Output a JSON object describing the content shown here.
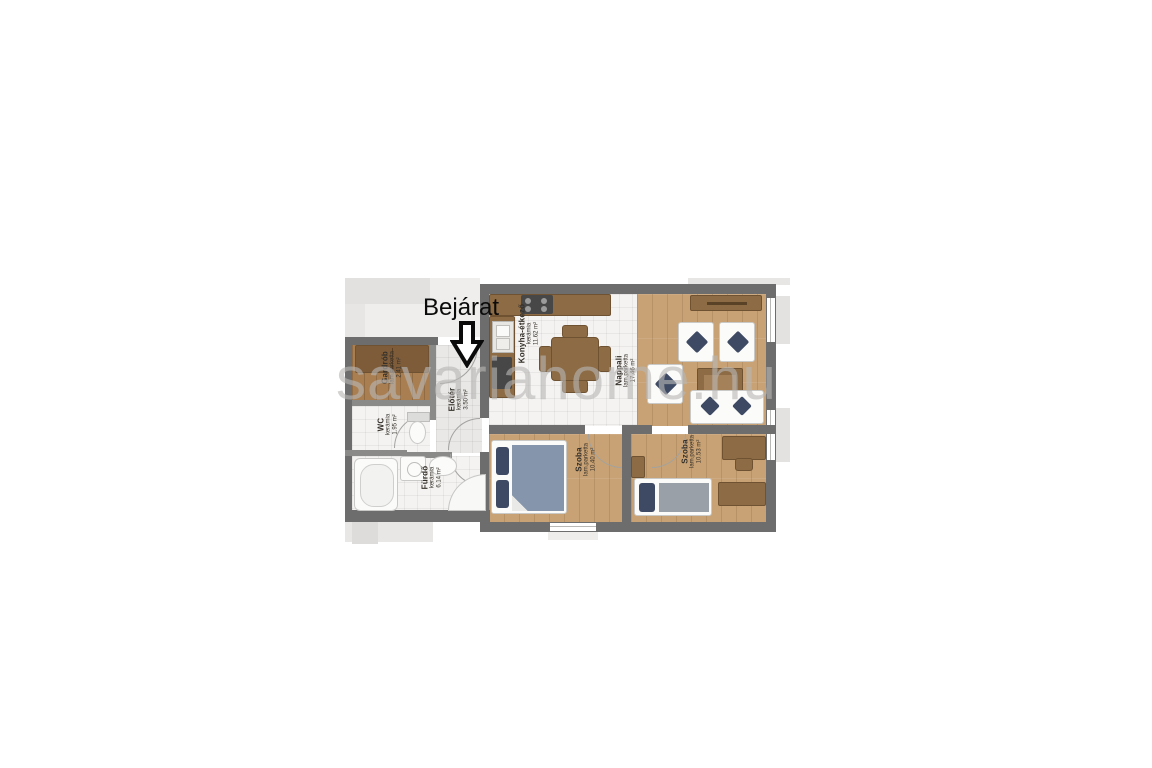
{
  "watermark": "savariahome.hu",
  "entrance": {
    "label": "Bejárat"
  },
  "rooms": {
    "gardrob": {
      "name": "Gardrób",
      "floor": "lam.parketta",
      "area": "2.41 m²"
    },
    "wc": {
      "name": "WC",
      "floor": "kerámia",
      "area": "1.95 m²"
    },
    "furdo": {
      "name": "Fürdő",
      "floor": "kerámia",
      "area": "6.14 m²"
    },
    "eloter": {
      "name": "Előtér",
      "floor": "kerámia",
      "area": "3.50 m²"
    },
    "konyha": {
      "name": "Konyha-étkező",
      "floor": "kerámia",
      "area": "11.62 m²"
    },
    "nappali": {
      "name": "Nappali",
      "floor": "lam.parketta",
      "area": "17.46 m²"
    },
    "szoba1": {
      "name": "Szoba",
      "floor": "lam.parketta",
      "area": "10.40 m²"
    },
    "szoba2": {
      "name": "Szoba",
      "floor": "lam.parketta",
      "area": "10.53 m²"
    }
  },
  "colors": {
    "wall": "#6d6d6d",
    "wood_floor": "#c8a274",
    "wood_dark": "#a97f52",
    "tile": "#f4f3f1",
    "furniture_brown": "#8d6b44",
    "pillow_navy": "#3e4a63",
    "blanket_blue": "#8495ac",
    "blanket_gray": "#9aa0a8",
    "watermark_gray": "#b8b7b5",
    "faded_neighbor": "#e9e8e6"
  }
}
